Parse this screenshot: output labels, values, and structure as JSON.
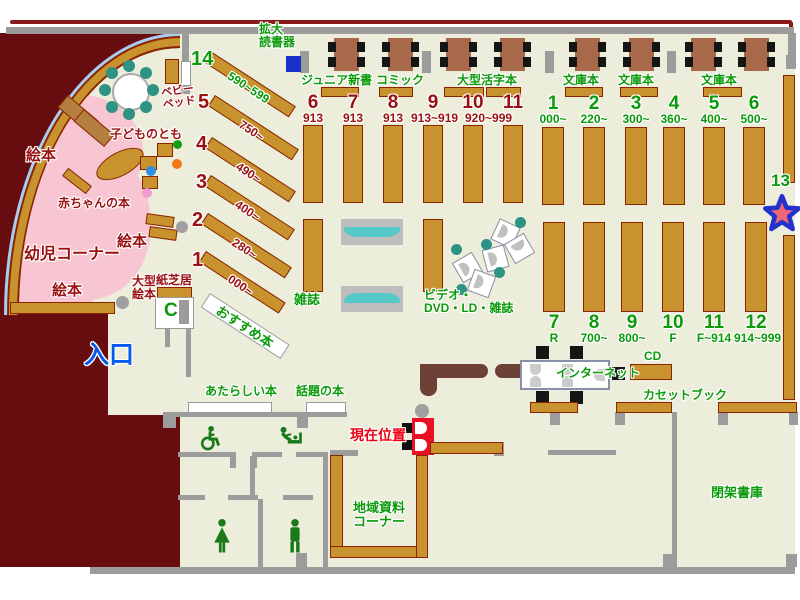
{
  "palette": {
    "floor": "#ededdc",
    "maroon": "#670d10",
    "wall_gray": "#9c9c9c",
    "shelf_tan": "#c8932f",
    "shelf_border": "#8b2500",
    "table_brown": "#a8684a",
    "chair_black": "#151515",
    "teal_seat": "#2e9384",
    "teal_display": "#55c8c8",
    "pink_area": "#f8c6d2",
    "arc_blue": "#a9cdf2",
    "green_text": "#0a9a0a",
    "dark_red_text": "#9a1010",
    "bright_red": "#ee0011",
    "blue_text": "#0459f0",
    "device_blue": "#1733cc",
    "marker_red": "#e81123",
    "star_fill": "#ee6677",
    "star_stroke": "#2233cc"
  },
  "labels": {
    "kakudai_l1": "拡大",
    "kakudai_l2": "読書器",
    "junior": "ジュニア新書",
    "comic": "コミック",
    "ogata_katsuji": "大型活字本",
    "bunko_a": "文庫本",
    "bunko_b": "文庫本",
    "bunko_c": "文庫本",
    "ehon_a": "絵本",
    "ehon_b": "絵本",
    "ehon_c": "絵本",
    "akachan": "赤ちゃんの本",
    "youji": "幼児コーナー",
    "kodomo": "子どものとも",
    "bed_l1": "ベビー",
    "bed_l2": "ベッド",
    "ogata_ehon_l1": "大型",
    "ogata_ehon_l2": "絵本",
    "kamishibai": "紙芝居",
    "zasshi": "雑誌",
    "video_l1": "ビデオ・",
    "video_l2": "DVD・LD・雑誌",
    "osusume": "おすすめ本",
    "internet": "インターネット",
    "cd": "CD",
    "cassette": "カセットブック",
    "new_books": "あたらしい本",
    "topic_books": "話題の本",
    "chiiki_l1": "地域資料",
    "chiiki_l2": "コーナー",
    "heika": "閉架書庫",
    "entrance": "入口",
    "current": "現在位置",
    "phone": "C",
    "n13": "13"
  },
  "shelves": {
    "diagonal": [
      {
        "no": "14",
        "range": "590~599"
      },
      {
        "no": "5",
        "range": "750~"
      },
      {
        "no": "4",
        "range": "490~"
      },
      {
        "no": "3",
        "range": "400~"
      },
      {
        "no": "2",
        "range": "280~"
      },
      {
        "no": "1",
        "range": "000~"
      }
    ],
    "mid_left": [
      {
        "no": "6",
        "sub": "913"
      },
      {
        "no": "7",
        "sub": "913"
      },
      {
        "no": "8",
        "sub": "913"
      },
      {
        "no": "9",
        "sub": "913~919"
      },
      {
        "no": "10",
        "sub": "920~999"
      },
      {
        "no": "11",
        "sub": ""
      }
    ],
    "mid_right": [
      {
        "no": "1",
        "sub": "000~"
      },
      {
        "no": "2",
        "sub": "220~"
      },
      {
        "no": "3",
        "sub": "300~"
      },
      {
        "no": "4",
        "sub": "360~"
      },
      {
        "no": "5",
        "sub": "400~"
      },
      {
        "no": "6",
        "sub": "500~"
      }
    ],
    "bottom": [
      {
        "no": "7",
        "sub": "R"
      },
      {
        "no": "8",
        "sub": "700~"
      },
      {
        "no": "9",
        "sub": "800~"
      },
      {
        "no": "10",
        "sub": "F"
      },
      {
        "no": "11",
        "sub": "F~914"
      },
      {
        "no": "12",
        "sub": "914~999"
      }
    ]
  }
}
